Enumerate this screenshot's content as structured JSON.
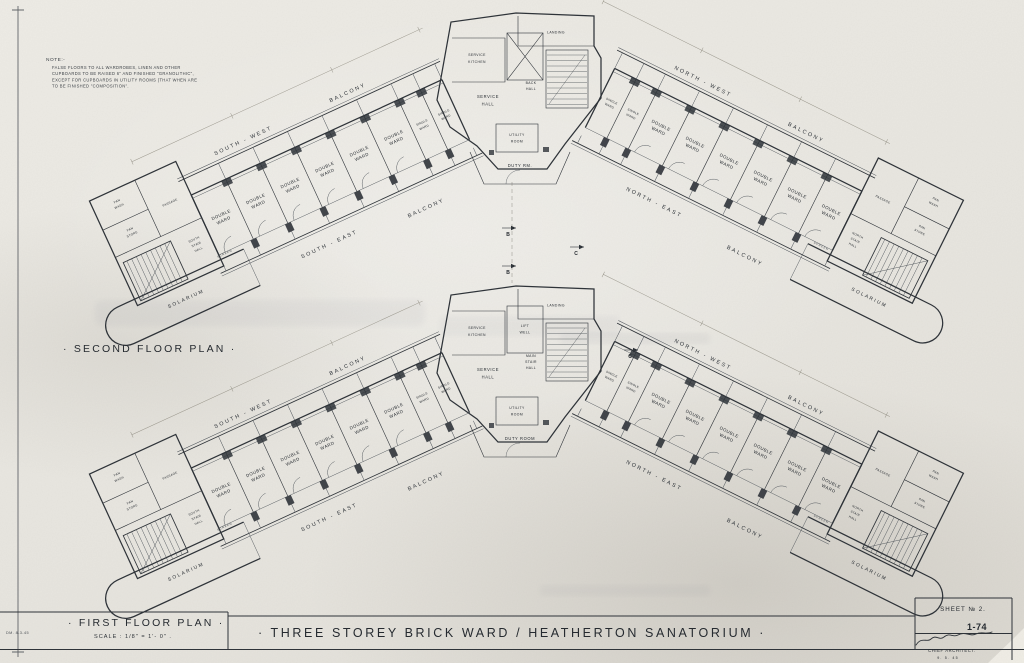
{
  "note": {
    "heading": "NOTE:-",
    "lines": [
      "FALSE FLOORS TO ALL WARDROBES, LINEN AND OTHER",
      "CUPBOARDS TO BE RAISED 6\" AND FINISHED \"GRANOLITHIC\",",
      "EXCEPT FOR CUPBOARDS IN UTILITY ROOMS (THAT WHEN ARE",
      "TO BE FINISHED \"COMPOSITION\"."
    ]
  },
  "plans": {
    "second": {
      "label": "· SECOND FLOOR PLAN ·",
      "core": {
        "landing": "LANDING",
        "kitchen": [
          "SERVICE",
          "KITCHEN"
        ],
        "hall": [
          "SERVICE",
          "HALL"
        ],
        "stair": [
          "BACK",
          "HALL"
        ],
        "utility": [
          "UTILITY",
          "ROOM"
        ],
        "duty": "DUTY RM."
      }
    },
    "first": {
      "label": "· FIRST FLOOR PLAN ·",
      "scale": "SCALE : 1/8\" = 1'- 0\" .",
      "core": {
        "landing": "LANDING",
        "kitchen": [
          "SERVICE",
          "KITCHEN"
        ],
        "lift": [
          "LIFT",
          "WELL"
        ],
        "hall": [
          "SERVICE",
          "HALL"
        ],
        "stair": [
          "MAIN",
          "STAIR",
          "HALL"
        ],
        "utility": [
          "UTILITY",
          "ROOM"
        ],
        "duty": "DUTY ROOM"
      }
    }
  },
  "wings": {
    "double_ward": [
      "DOUBLE",
      "WARD"
    ],
    "single_ward": [
      "SINGLE",
      "WARD"
    ],
    "balcony": "BALCONY",
    "south_west": "SOUTH - WEST",
    "south_east": "SOUTH - EAST",
    "north_west": "NORTH - WEST",
    "north_east": "NORTH - EAST",
    "solarium": "SOLARIUM",
    "screen": "SCREEN",
    "pan_wash": [
      "PAN",
      "WASH"
    ],
    "pan_store": [
      "PAN",
      "STORE"
    ],
    "passage": "PASSAGE",
    "south_stair_hall": [
      "SOUTH",
      "STAIR",
      "HALL"
    ],
    "north_stair_hall": [
      "NORTH",
      "STAIR",
      "HALL"
    ]
  },
  "markers": {
    "b": "B",
    "c": "C"
  },
  "title_block": {
    "title": "· THREE STOREY BRICK WARD / HEATHERTON SANATORIUM ·",
    "sheet_no": "SHEET № 2.",
    "drawing_no": "1-74",
    "architect": "CHIEF ARCHITECT:",
    "date": "9. 5. 45",
    "ref": "DM. 8-3-45"
  },
  "colors": {
    "ink": "#2c3137",
    "paper": "#e9e7e0"
  }
}
